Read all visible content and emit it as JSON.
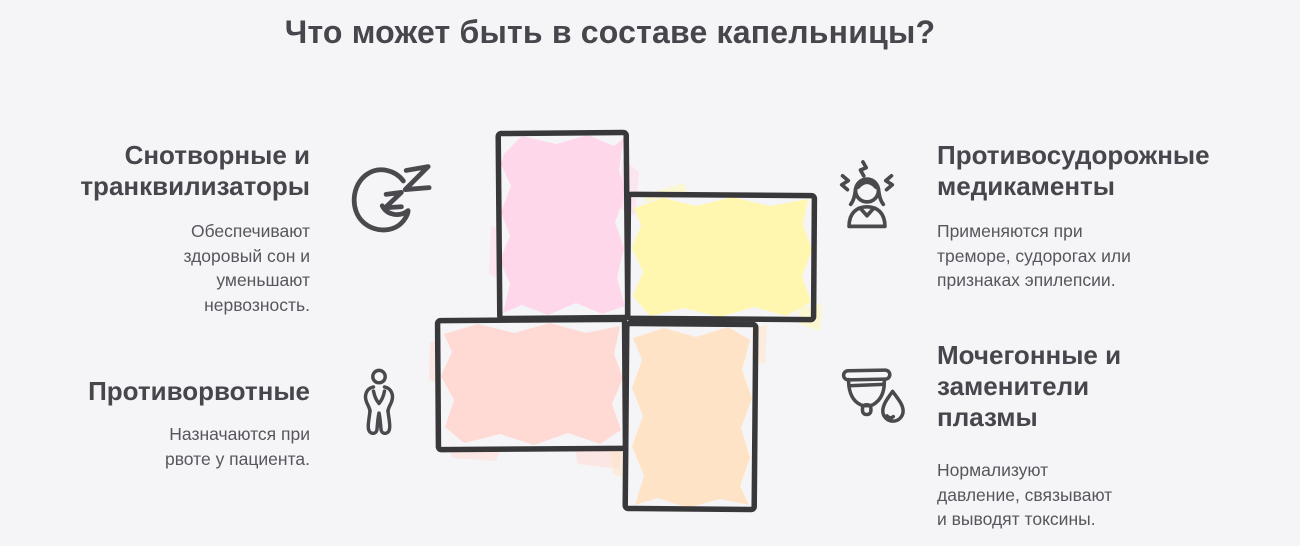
{
  "title": "Что может быть в составе капельницы?",
  "colors": {
    "background": "#f5f5f8",
    "heading_text": "#46464c",
    "body_text": "#56565d",
    "outline_stroke": "#38383a",
    "icon_stroke": "#4a4a4e",
    "cell_pink": "#ffd7eb",
    "cell_yellow": "#fff7b0",
    "cell_salmon": "#ffd9d3",
    "cell_orange": "#ffe3c6"
  },
  "diagram": {
    "shape": "pinwheel-cross of 4 sketched rectangles",
    "cells": [
      "pink",
      "yellow",
      "salmon",
      "orange"
    ]
  },
  "sections": [
    {
      "id": "sedatives",
      "icon": "sleep-moon-icon",
      "heading": "Снотворные и транквилизаторы",
      "description": "Обеспечивают здоровый сон и уменьшают нервозность."
    },
    {
      "id": "anticonvulsants",
      "icon": "tremor-person-icon",
      "heading": "Противосудорожные медикаменты",
      "description": "Применяются при треморе, судорогах или признаках эпилепсии."
    },
    {
      "id": "antiemetics",
      "icon": "nausea-person-icon",
      "heading": "Противорвотные",
      "description": "Назначаются при рвоте у пациента."
    },
    {
      "id": "diuretics",
      "icon": "cup-droplet-icon",
      "heading": "Мочегонные и заменители плазмы",
      "description": "Нормализуют давление, связывают и выводят токсины."
    }
  ]
}
